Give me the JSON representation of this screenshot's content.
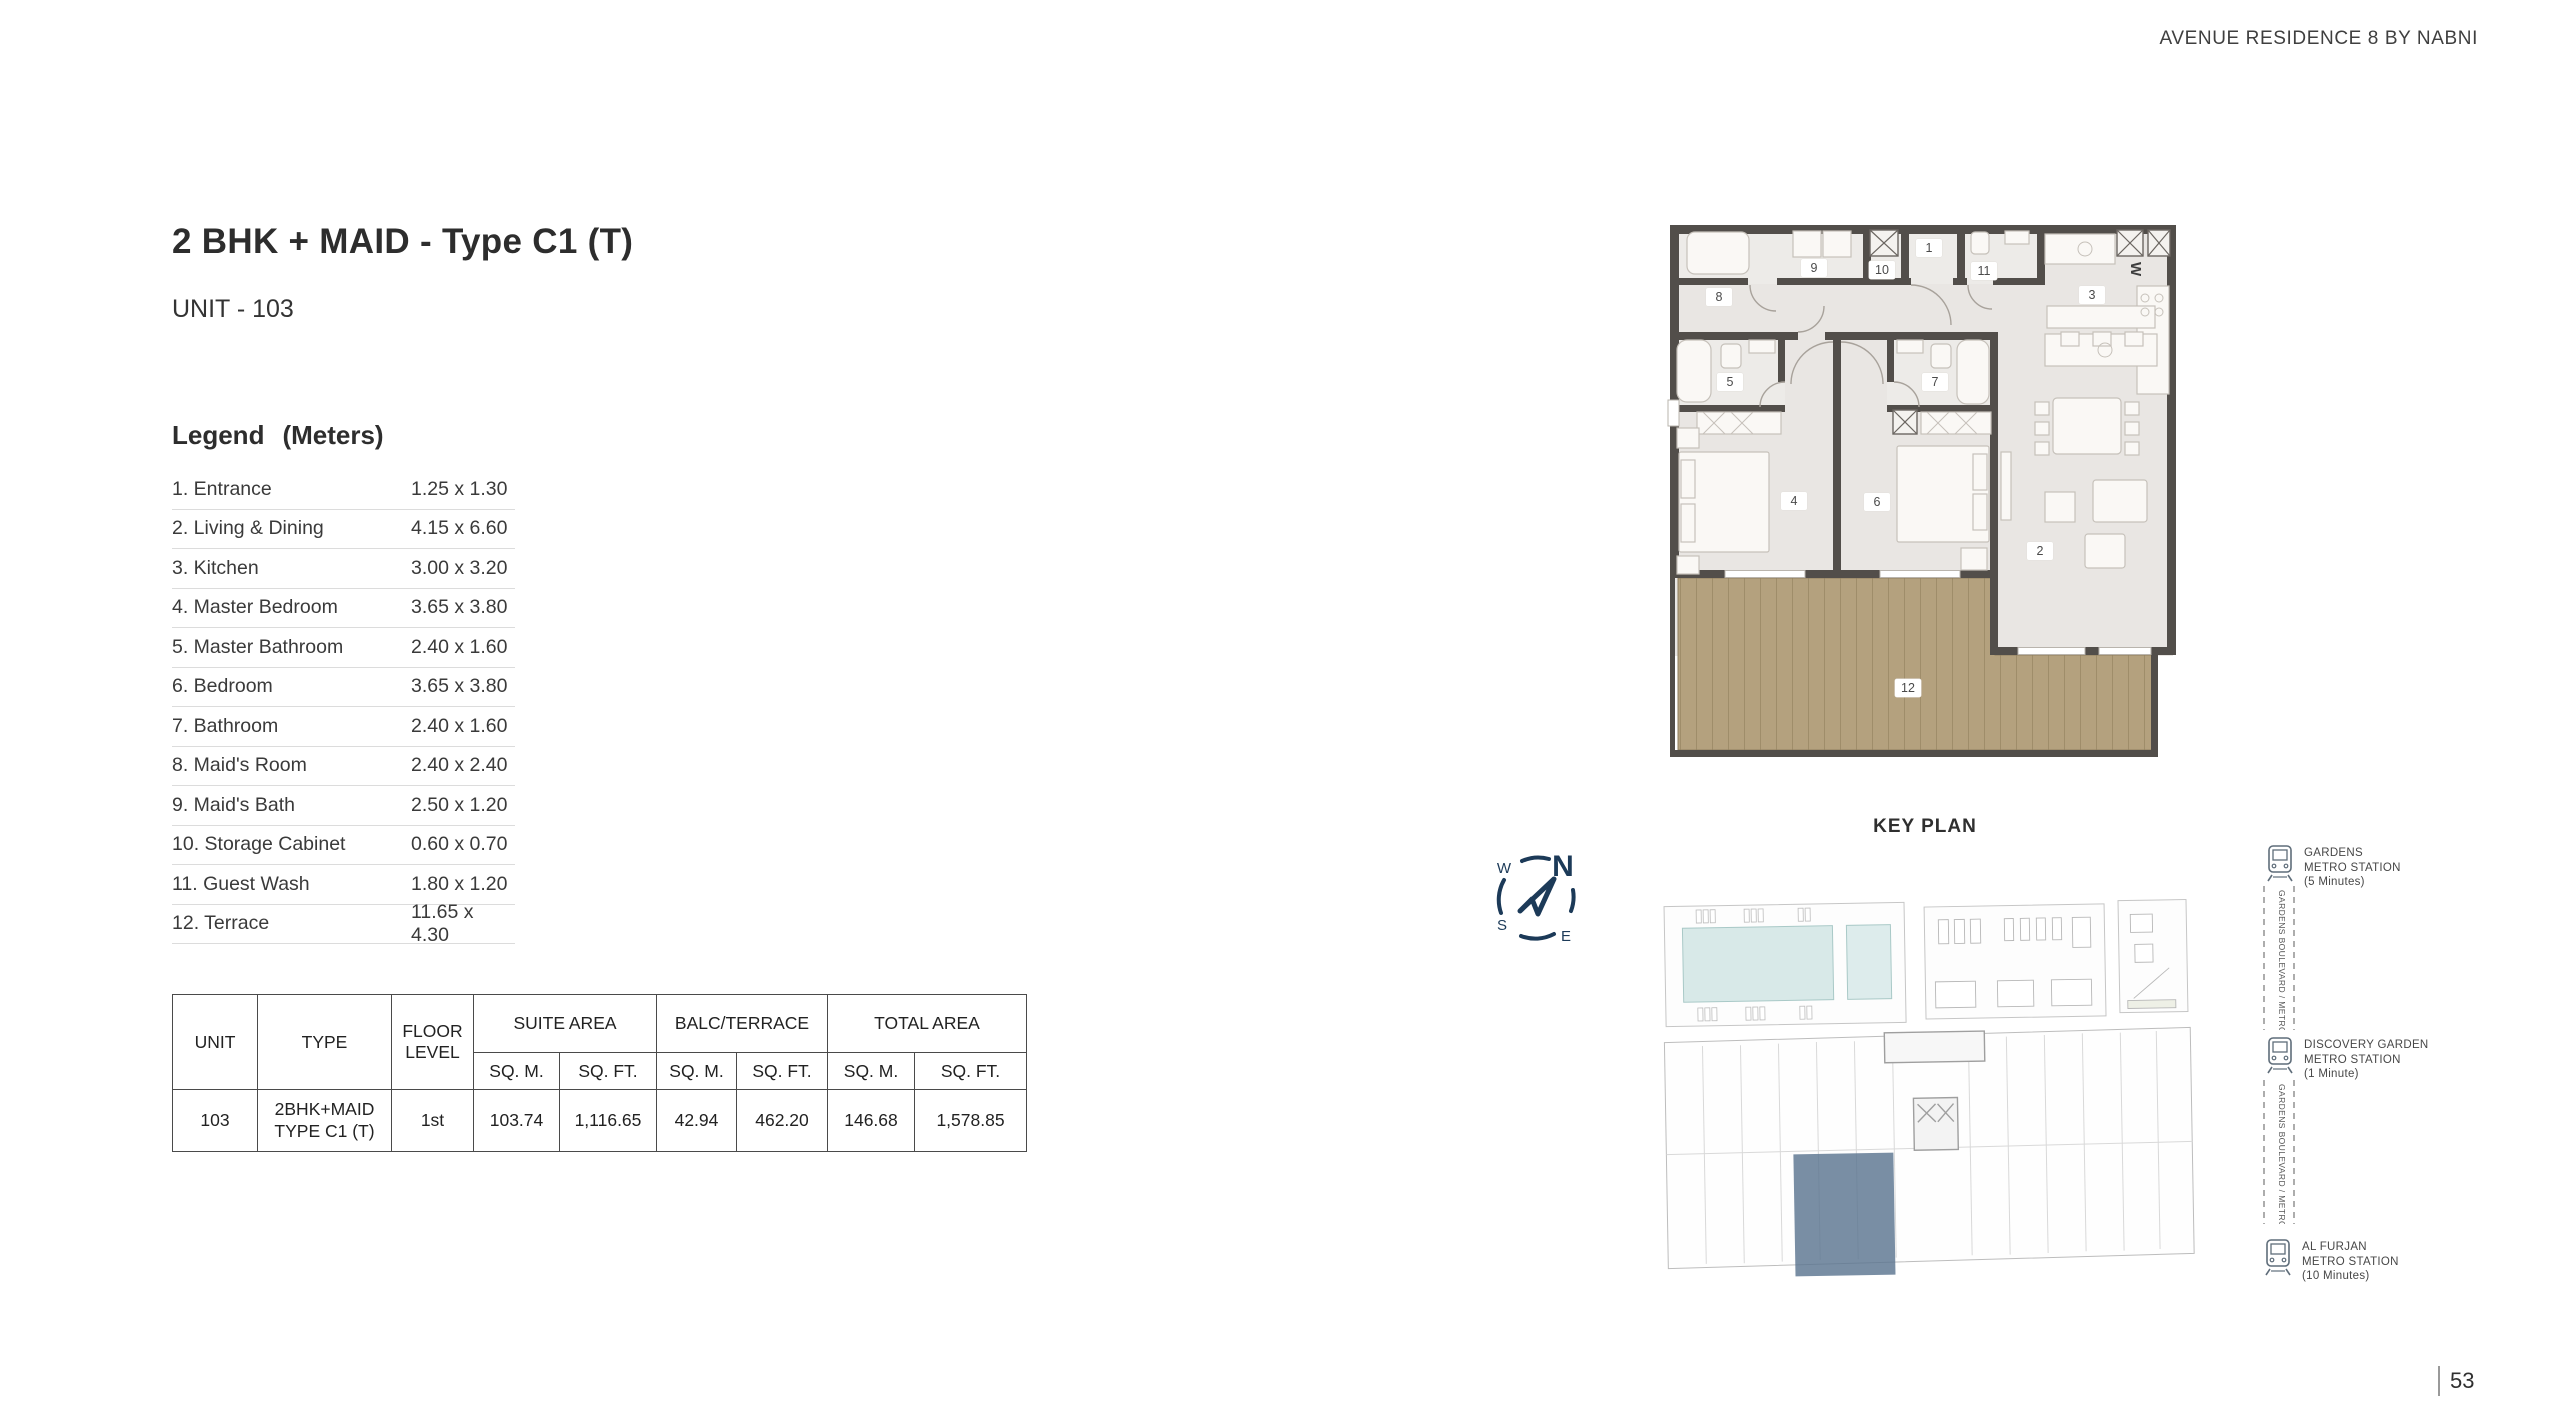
{
  "header": {
    "brand": "AVENUE RESIDENCE 8 BY NABNI"
  },
  "unit": {
    "title": "2 BHK + MAID - Type C1 (T)",
    "subtitle": "UNIT - 103"
  },
  "legend": {
    "title": "Legend",
    "units_label": "(Meters)",
    "items": [
      {
        "label": "1. Entrance",
        "dims": "1.25 x 1.30"
      },
      {
        "label": "2. Living & Dining",
        "dims": "4.15 x 6.60"
      },
      {
        "label": "3. Kitchen",
        "dims": "3.00 x 3.20"
      },
      {
        "label": "4. Master Bedroom",
        "dims": "3.65 x 3.80"
      },
      {
        "label": "5. Master Bathroom",
        "dims": "2.40 x 1.60"
      },
      {
        "label": "6. Bedroom",
        "dims": "3.65 x 3.80"
      },
      {
        "label": "7. Bathroom",
        "dims": "2.40 x 1.60"
      },
      {
        "label": "8. Maid's Room",
        "dims": "2.40 x 2.40"
      },
      {
        "label": "9. Maid's Bath",
        "dims": "2.50 x 1.20"
      },
      {
        "label": "10. Storage Cabinet",
        "dims": "0.60 x 0.70"
      },
      {
        "label": "11. Guest Wash",
        "dims": "1.80 x 1.20"
      },
      {
        "label": "12. Terrace",
        "dims": "11.65 x 4.30"
      }
    ]
  },
  "area_table": {
    "col_unit": "UNIT",
    "col_type": "TYPE",
    "col_floor": "FLOOR LEVEL",
    "grp_suite": "SUITE AREA",
    "grp_balc": "BALC/TERRACE",
    "grp_total": "TOTAL AREA",
    "sub_sqm": "SQ. M.",
    "sub_sqft": "SQ. FT.",
    "row": {
      "unit": "103",
      "type_line1": "2BHK+MAID",
      "type_line2": "TYPE C1 (T)",
      "floor": "1st",
      "suite_sqm": "103.74",
      "suite_sqft": "1,116.65",
      "balc_sqm": "42.94",
      "balc_sqft": "462.20",
      "total_sqm": "146.68",
      "total_sqft": "1,578.85"
    }
  },
  "floor_plan": {
    "rooms": [
      "1",
      "2",
      "3",
      "4",
      "5",
      "6",
      "7",
      "8",
      "9",
      "10",
      "11",
      "12"
    ],
    "washer_label": "W"
  },
  "key_plan": {
    "title": "KEY PLAN",
    "highlight_color": "#5b7590"
  },
  "compass": {
    "n": "N",
    "e": "E",
    "s": "S",
    "w": "W"
  },
  "metro": {
    "road_label": "GARDENS BOULEVARD / METRO VIEW",
    "stations": [
      {
        "name1": "GARDENS",
        "name2": "METRO STATION",
        "time": "(5 Minutes)"
      },
      {
        "name1": "DISCOVERY GARDEN",
        "name2": "METRO STATION",
        "time": "(1 Minute)"
      },
      {
        "name1": "AL FURJAN",
        "name2": "METRO STATION",
        "time": "(10 Minutes)"
      }
    ]
  },
  "page": {
    "number": "53"
  },
  "colors": {
    "compass_navy": "#1c3a58",
    "keyplan_highlight": "#5b7590",
    "terrace_wood": "#b4a17e",
    "wall": "#524e4a"
  }
}
